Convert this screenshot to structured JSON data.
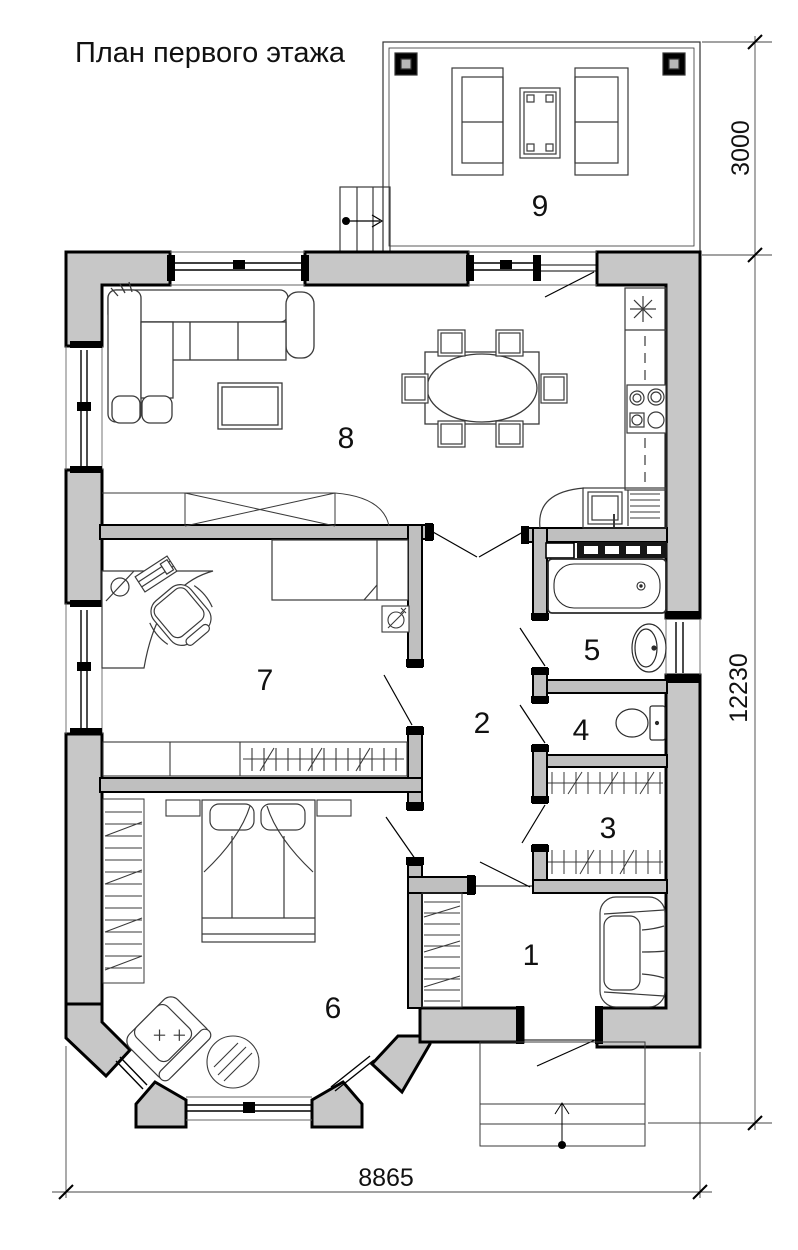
{
  "title": "План первого этажа",
  "rooms": {
    "r1": {
      "number": "1"
    },
    "r2": {
      "number": "2"
    },
    "r3": {
      "number": "3"
    },
    "r4": {
      "number": "4"
    },
    "r5": {
      "number": "5"
    },
    "r6": {
      "number": "6"
    },
    "r7": {
      "number": "7"
    },
    "r8": {
      "number": "8"
    },
    "r9": {
      "number": "9"
    }
  },
  "dimensions": {
    "terrace_depth": {
      "value": "3000",
      "orientation": "vertical"
    },
    "house_length": {
      "value": "12230",
      "orientation": "vertical"
    },
    "house_width": {
      "value": "8865",
      "orientation": "horizontal"
    }
  },
  "colors": {
    "exterior_wall_fill": "#c7c7c7",
    "interior_wall_fill": "#bfbfbf",
    "line": "#000000",
    "background": "#ffffff"
  }
}
